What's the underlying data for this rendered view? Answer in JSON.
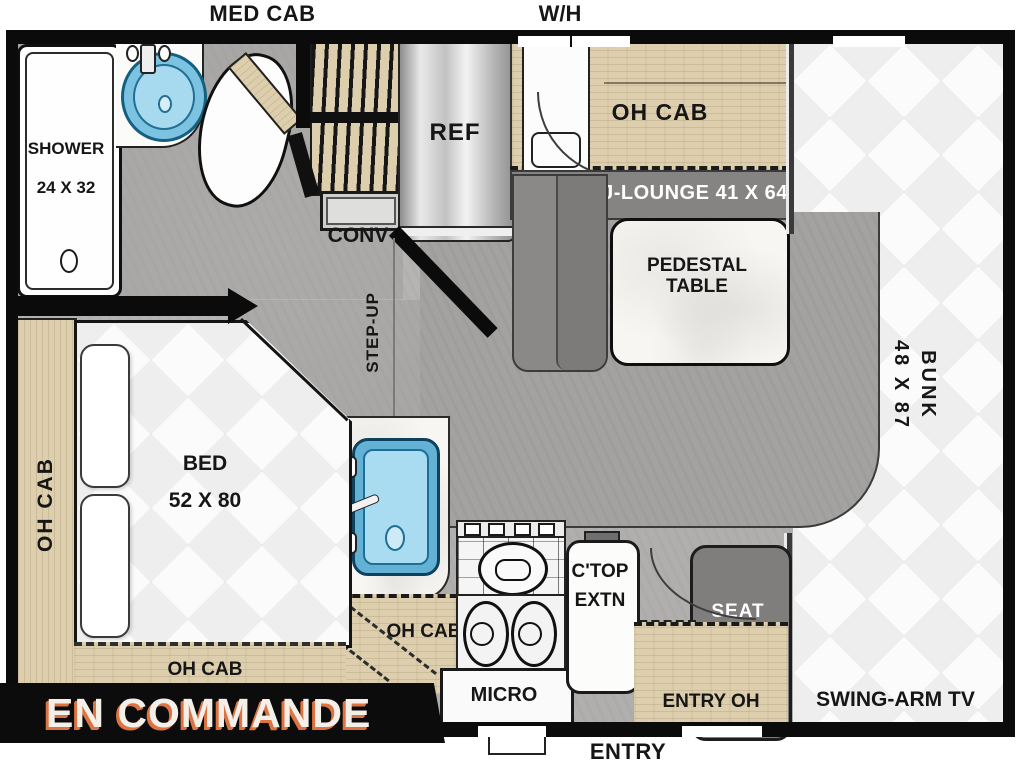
{
  "exterior": {
    "med_cab": "MED CAB",
    "water_heater": "W/H",
    "entry": "ENTRY"
  },
  "bathroom": {
    "shower_line1": "SHOWER",
    "shower_line2": "24 X 32",
    "conv": "CONV"
  },
  "kitchen": {
    "ref": "REF",
    "step_up": "STEP-UP",
    "oh_cab": "OH CAB",
    "micro": "MICRO",
    "ctop_line1": "C'TOP",
    "ctop_line2": "EXTN",
    "entry_oh": "ENTRY OH"
  },
  "dinette": {
    "oh_cab": "OH CAB",
    "j_lounge": "J-LOUNGE 41 X 64",
    "table_line1": "PEDESTAL",
    "table_line2": "TABLE",
    "seat": "SEAT"
  },
  "bunk": {
    "line1": "BUNK",
    "line2": "48 X 87",
    "swing_arm_tv": "SWING-ARM TV"
  },
  "bedroom": {
    "bed_line1": "BED",
    "bed_line2": "52 X 80",
    "oh_cab_left": "OH CAB",
    "oh_cab_bottom": "OH CAB"
  },
  "banner": {
    "text": "EN COMMANDE"
  },
  "colors": {
    "wall": "#0b0b0b",
    "wood": "#ddcfae",
    "floor": "#b1afad",
    "platform": "#a3a2a0",
    "seat_gray": "#7f7e7d",
    "lounge_gray": "#8a8988",
    "sink_blue": "#63b2d5",
    "accent_orange": "#dd7340",
    "mattress_white": "#fbfbfb"
  }
}
